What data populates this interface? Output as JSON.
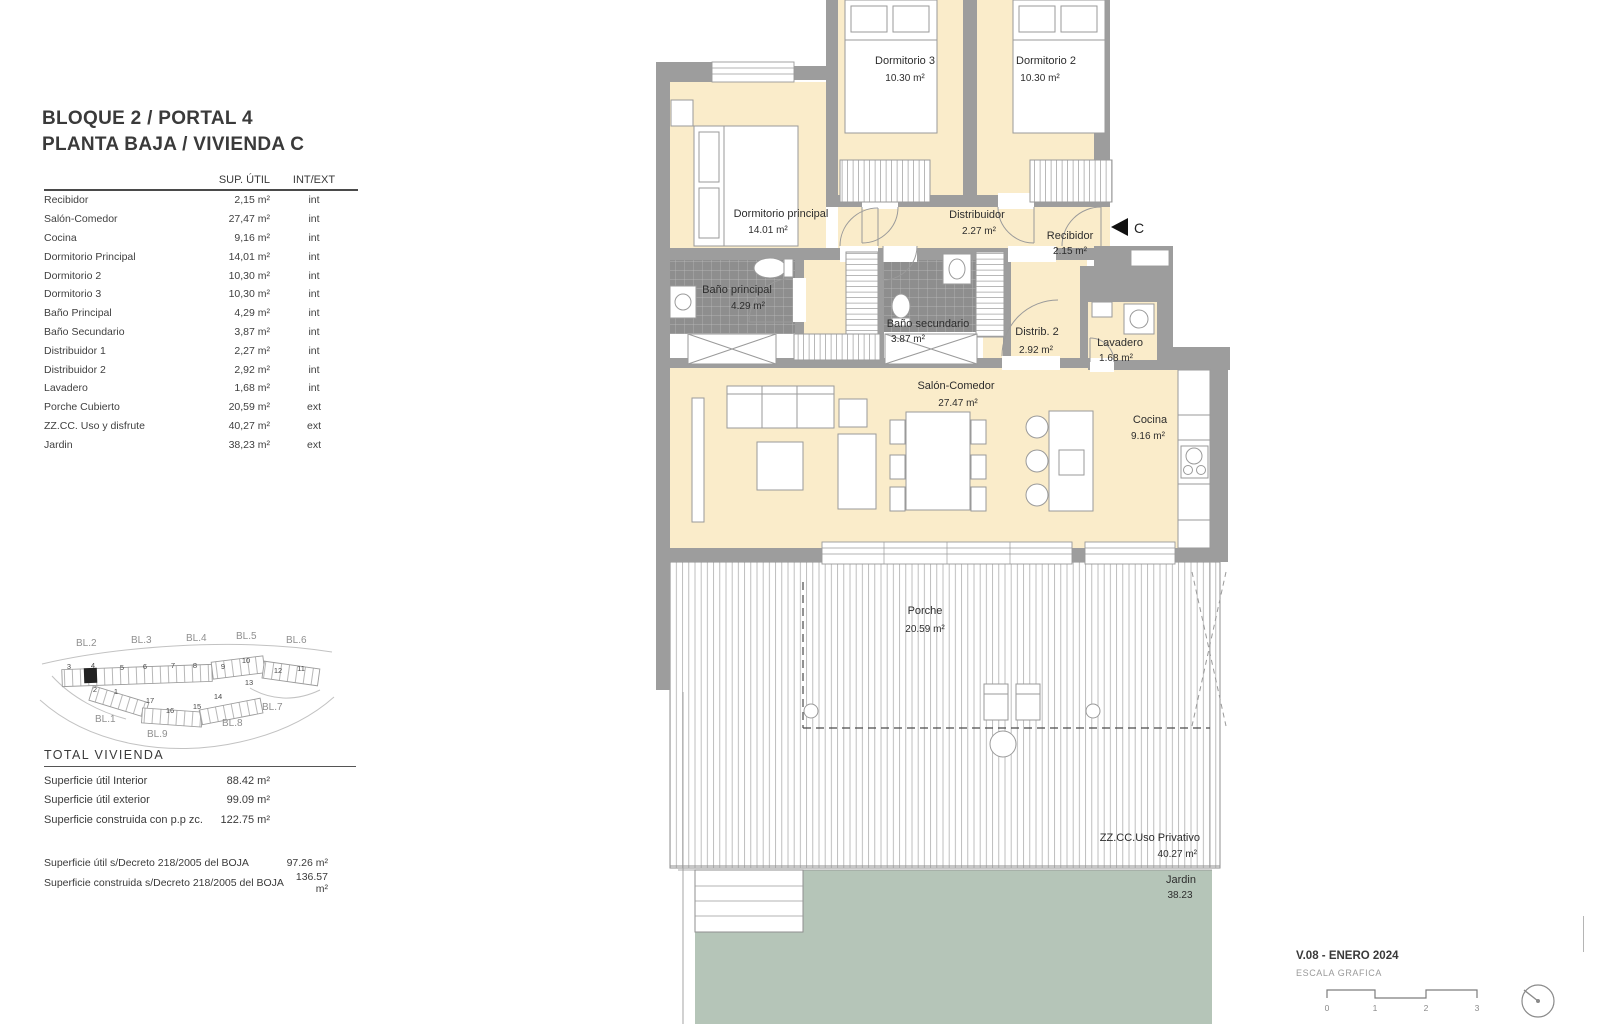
{
  "header": {
    "title_line1": "BLOQUE 2 / PORTAL 4",
    "title_line2": "PLANTA BAJA / VIVIENDA C"
  },
  "area_table": {
    "col_sup": "SUP.  ÚTIL",
    "col_intext": "INT/EXT",
    "rows": [
      {
        "label": "Recibidor",
        "sup": "2,15 m²",
        "loc": "int"
      },
      {
        "label": "Salón-Comedor",
        "sup": "27,47 m²",
        "loc": "int"
      },
      {
        "label": "Cocina",
        "sup": "9,16 m²",
        "loc": "int"
      },
      {
        "label": "Dormitorio Principal",
        "sup": "14,01 m²",
        "loc": "int"
      },
      {
        "label": "Dormitorio 2",
        "sup": "10,30 m²",
        "loc": "int"
      },
      {
        "label": "Dormitorio 3",
        "sup": "10,30 m²",
        "loc": "int"
      },
      {
        "label": "Baño Principal",
        "sup": "4,29 m²",
        "loc": "int"
      },
      {
        "label": "Baño Secundario",
        "sup": "3,87 m²",
        "loc": "int"
      },
      {
        "label": "Distribuidor 1",
        "sup": "2,27 m²",
        "loc": "int"
      },
      {
        "label": "Distribuidor 2",
        "sup": "2,92 m²",
        "loc": "int"
      },
      {
        "label": "Lavadero",
        "sup": "1,68 m²",
        "loc": "int"
      },
      {
        "label": "Porche Cubierto",
        "sup": "20,59 m²",
        "loc": "ext"
      },
      {
        "label": "ZZ.CC. Uso y disfrute",
        "sup": "40,27 m²",
        "loc": "ext"
      },
      {
        "label": "Jardin",
        "sup": "38,23 m²",
        "loc": "ext"
      }
    ]
  },
  "site_map": {
    "blocks": [
      "BL.2",
      "BL.3",
      "BL.4",
      "BL.5",
      "BL.6",
      "BL.1",
      "BL.9",
      "BL.8",
      "BL.7"
    ],
    "units": [
      "3",
      "4",
      "5",
      "6",
      "7",
      "8",
      "9",
      "10",
      "11",
      "12",
      "13",
      "14",
      "15",
      "16",
      "17",
      "1",
      "2"
    ]
  },
  "totals": {
    "heading": "TOTAL VIVIENDA",
    "rows": [
      {
        "label": "Superficie útil Interior",
        "value": "88.42 m²"
      },
      {
        "label": "Superficie útil exterior",
        "value": "99.09 m²"
      },
      {
        "label": "Superficie construida con p.p zc.",
        "value": "122.75 m²"
      }
    ]
  },
  "boja": {
    "rows": [
      {
        "label": "Superficie útil s/Decreto 218/2005 del BOJA",
        "value": "97.26 m²"
      },
      {
        "label": "Superficie construida s/Decreto 218/2005 del BOJA",
        "value": "136.57 m²"
      }
    ]
  },
  "plan": {
    "entrance_label": "C",
    "rooms": [
      {
        "name": "Dormitorio 3",
        "area": "10.30 m²"
      },
      {
        "name": "Dormitorio 2",
        "area": "10.30 m²"
      },
      {
        "name": "Dormitorio principal",
        "area": "14.01 m²"
      },
      {
        "name": "Distribuidor",
        "area": "2.27 m²"
      },
      {
        "name": "Recibidor",
        "area": "2.15 m²"
      },
      {
        "name": "Baño principal",
        "area": "4.29 m²"
      },
      {
        "name": "Baño secundario",
        "area": "3.87 m²"
      },
      {
        "name": "Distrib. 2",
        "area": "2.92 m²"
      },
      {
        "name": "Lavadero",
        "area": "1.68 m²"
      },
      {
        "name": "Salón-Comedor",
        "area": "27.47 m²"
      },
      {
        "name": "Cocina",
        "area": "9.16 m²"
      },
      {
        "name": "Porche",
        "area": "20.59 m²"
      },
      {
        "name": "ZZ.CC.Uso Privativo",
        "area": "40.27 m²"
      },
      {
        "name": "Jardin",
        "area": "38.23"
      }
    ]
  },
  "footer": {
    "version": "V.08 - ENERO 2024",
    "scale_label": "ESCALA GRAFICA",
    "scale_ticks": [
      "0",
      "1",
      "2",
      "3"
    ]
  },
  "colors": {
    "room_fill": "#faecca",
    "wall_gray": "#9d9d9d",
    "tile_gray": "#8e8e8e",
    "garden_green": "#b5c5b8",
    "text_dark": "#2d2d2d"
  }
}
